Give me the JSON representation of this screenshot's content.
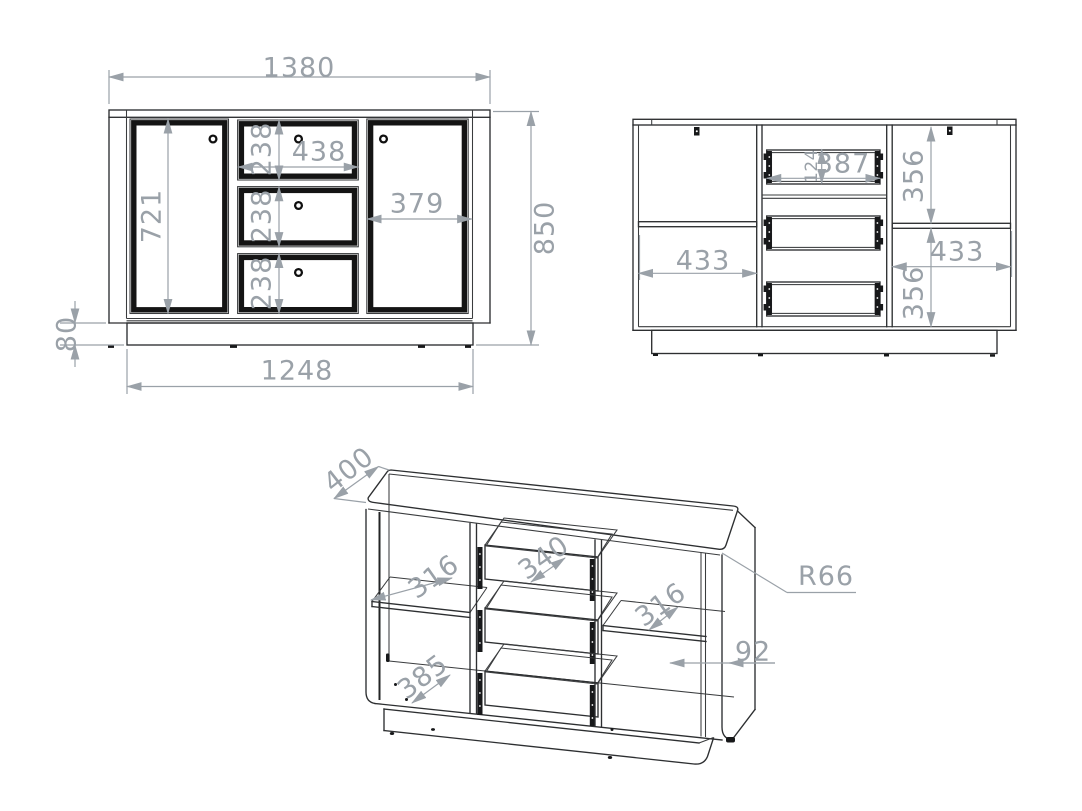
{
  "colors": {
    "background": "#ffffff",
    "cabinet_line": "#2d2f31",
    "hardware_black": "#17181a",
    "dimension_gray": "#9aa1a8"
  },
  "front_view": {
    "overall_width": "1380",
    "overall_height": "850",
    "left_door_height": "721",
    "drawer_1_height": "238",
    "drawer_2_height": "238",
    "drawer_3_height": "238",
    "top_drawer_width": "438",
    "right_door_width": "379",
    "plinth_height": "80",
    "base_width": "1248"
  },
  "internal_view": {
    "left_compartment_width": "433",
    "drawer_box_width": "387",
    "drawer_box_height": "124",
    "right_top_compartment_height": "356",
    "right_compartment_width": "433",
    "right_bottom_compartment_height": "356"
  },
  "isometric_view": {
    "depth": "400",
    "left_shelf_depth": "316",
    "drawer_depth": "340",
    "right_shelf_depth": "316",
    "bottom_shelf_depth": "385",
    "corner_radius": "R66",
    "wall_clearance": "92"
  }
}
